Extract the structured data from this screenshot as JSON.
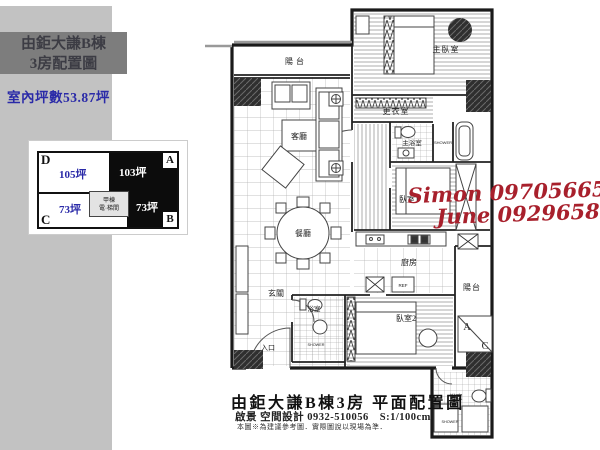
{
  "sidebar": {
    "band_color": "#c2c2c2",
    "title_box": {
      "bg": "#7d7d7d",
      "line1": "由鉅大謙B棟",
      "line2": "3房配置圖"
    },
    "area_text": "室內坪數53.87坪",
    "blue": "#2a2aa8"
  },
  "unit_diagram": {
    "core_line1": "甲棟",
    "core_line2": "電·梯間",
    "cells": [
      {
        "id": "D",
        "area": "105坪",
        "style": "white",
        "corner": "top-left"
      },
      {
        "id": "A",
        "area": "103坪",
        "style": "black",
        "corner": "top-right"
      },
      {
        "id": "C",
        "area": "73坪",
        "style": "white",
        "corner": "bottom-left"
      },
      {
        "id": "B",
        "area": "73坪",
        "style": "black",
        "corner": "bottom-right"
      }
    ]
  },
  "floorplan": {
    "labels": {
      "balcony_top": "陽台",
      "master_bedroom": "主臥室",
      "dressing": "更衣室",
      "master_bath": "主浴室",
      "shower1": "SHOWER",
      "living": "客廳",
      "bedroom1": "臥室1",
      "dining": "餐廳",
      "kitchen": "廚房",
      "ref": "REF",
      "foyer": "玄關",
      "bath2": "浴室",
      "shower2": "SHOWER",
      "bedroom2": "臥室2",
      "balcony_right": "陽台",
      "ac_a": "A",
      "ac_c": "C",
      "entrance": "入口",
      "bath3": "浴室",
      "shower3": "SHOWER"
    }
  },
  "watermark": {
    "line1": "Simon 0970566507",
    "line2": "June 0929658299",
    "color": "#a8202c"
  },
  "footer": {
    "title": "由鉅大謙B棟3房 平面配置圖",
    "subtitle": "啟景 空間設計 0932-510056　S:1/100cm",
    "note": "本圖※為建議參考圖．實際圖說以現場為準．"
  }
}
